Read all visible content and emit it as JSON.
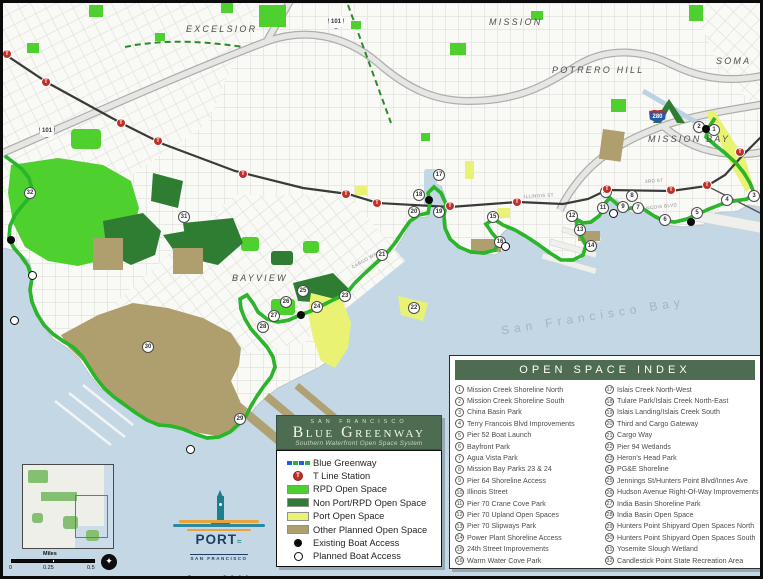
{
  "map": {
    "neighborhoods": [
      {
        "label": "EXCELSIOR",
        "x": 183,
        "y": 21
      },
      {
        "label": "MISSION",
        "x": 486,
        "y": 14
      },
      {
        "label": "POTRERO HILL",
        "x": 549,
        "y": 62
      },
      {
        "label": "SOMA",
        "x": 713,
        "y": 53
      },
      {
        "label": "MISSION BAY",
        "x": 645,
        "y": 131
      },
      {
        "label": "BAYVIEW",
        "x": 229,
        "y": 270
      }
    ],
    "bay_label": "San Francisco Bay",
    "street_labels": [
      {
        "label": "3RD ST",
        "x": 642,
        "y": 176,
        "rot": -4
      },
      {
        "label": "ILLINOIS ST",
        "x": 521,
        "y": 191,
        "rot": -3
      },
      {
        "label": "CARGO WAY",
        "x": 349,
        "y": 262,
        "rot": -30
      },
      {
        "label": "TERRY A FRANCOIS BLVD",
        "x": 610,
        "y": 206,
        "rot": -6
      }
    ],
    "shields": [
      {
        "system": "US",
        "label": "101"
      },
      {
        "system": "US",
        "label": "101"
      },
      {
        "system": "Interstate",
        "label": "280"
      }
    ],
    "markers": [
      {
        "n": 1,
        "x": 711,
        "y": 127
      },
      {
        "n": 2,
        "x": 696,
        "y": 124
      },
      {
        "n": 3,
        "x": 751,
        "y": 193
      },
      {
        "n": 4,
        "x": 724,
        "y": 197
      },
      {
        "n": 5,
        "x": 694,
        "y": 210
      },
      {
        "n": 6,
        "x": 662,
        "y": 217
      },
      {
        "n": 7,
        "x": 635,
        "y": 205
      },
      {
        "n": 8,
        "x": 629,
        "y": 193
      },
      {
        "n": 9,
        "x": 620,
        "y": 204
      },
      {
        "n": 10,
        "x": 603,
        "y": 189
      },
      {
        "n": 11,
        "x": 600,
        "y": 205
      },
      {
        "n": 12,
        "x": 569,
        "y": 213
      },
      {
        "n": 13,
        "x": 577,
        "y": 227
      },
      {
        "n": 14,
        "x": 588,
        "y": 243
      },
      {
        "n": 15,
        "x": 490,
        "y": 214
      },
      {
        "n": 16,
        "x": 497,
        "y": 239
      },
      {
        "n": 17,
        "x": 436,
        "y": 172
      },
      {
        "n": 18,
        "x": 416,
        "y": 192
      },
      {
        "n": 19,
        "x": 436,
        "y": 209
      },
      {
        "n": 20,
        "x": 411,
        "y": 209
      },
      {
        "n": 21,
        "x": 379,
        "y": 252
      },
      {
        "n": 22,
        "x": 411,
        "y": 305
      },
      {
        "n": 23,
        "x": 342,
        "y": 293
      },
      {
        "n": 24,
        "x": 314,
        "y": 304
      },
      {
        "n": 25,
        "x": 300,
        "y": 288
      },
      {
        "n": 26,
        "x": 283,
        "y": 299
      },
      {
        "n": 27,
        "x": 271,
        "y": 313
      },
      {
        "n": 28,
        "x": 260,
        "y": 324
      },
      {
        "n": 29,
        "x": 237,
        "y": 416
      },
      {
        "n": 30,
        "x": 145,
        "y": 344
      },
      {
        "n": 31,
        "x": 181,
        "y": 214
      },
      {
        "n": 32,
        "x": 27,
        "y": 190
      }
    ],
    "t_stations": [
      [
        4,
        51
      ],
      [
        43,
        79
      ],
      [
        118,
        120
      ],
      [
        155,
        138
      ],
      [
        240,
        171
      ],
      [
        343,
        191
      ],
      [
        374,
        200
      ],
      [
        447,
        203
      ],
      [
        514,
        199
      ],
      [
        604,
        186
      ],
      [
        668,
        187
      ],
      [
        704,
        182
      ],
      [
        737,
        149
      ]
    ],
    "existing_boat_access": [
      [
        703,
        126
      ],
      [
        688,
        219
      ],
      [
        426,
        197
      ],
      [
        298,
        312
      ],
      [
        8,
        237
      ]
    ],
    "planned_boat_access": [
      [
        610,
        210
      ],
      [
        502,
        243
      ],
      [
        29,
        272
      ],
      [
        11,
        317
      ],
      [
        187,
        446
      ]
    ]
  },
  "colors": {
    "water": "#c3d7e5",
    "land": "#f9f9f6",
    "greenway_blue": "#1e5fe0",
    "greenway_green": "#2bb52b",
    "rpd_green": "#4ed02f",
    "non_port_green": "#2e7d33",
    "port_yellow": "#e9f272",
    "planned_tan": "#b09f6e",
    "panel_green": "#4d6c51",
    "t_red": "#c03028"
  },
  "title_block": {
    "city": "SAN FRANCISCO",
    "title": "Blue Greenway",
    "subtitle": "Southern Waterfront Open Space System"
  },
  "legend": {
    "items": [
      {
        "symbol": "greenway",
        "icon": "blue-greenway-dash-icon",
        "label": "Blue Greenway"
      },
      {
        "symbol": "tdot",
        "icon": "t-line-station-icon",
        "label": "T Line Station"
      },
      {
        "symbol": "chip",
        "color": "#4ed02f",
        "icon": "rpd-open-space-swatch",
        "label": "RPD Open Space"
      },
      {
        "symbol": "chip",
        "color": "#2e7d33",
        "icon": "non-port-rpd-swatch",
        "label": "Non Port/RPD Open Space"
      },
      {
        "symbol": "chip",
        "color": "#e9f272",
        "icon": "port-open-space-swatch",
        "label": "Port Open Space"
      },
      {
        "symbol": "chip",
        "color": "#b09f6e",
        "icon": "other-planned-swatch",
        "label": "Other Planned Open Space"
      },
      {
        "symbol": "bdot",
        "icon": "existing-boat-access-icon",
        "label": "Existing Boat Access"
      },
      {
        "symbol": "pdot",
        "icon": "planned-boat-access-icon",
        "label": "Planned Boat Access"
      }
    ]
  },
  "index_panel": {
    "header": "OPEN SPACE INDEX",
    "left": [
      {
        "num": 1,
        "label": "Mission Creek Shoreline North"
      },
      {
        "num": 2,
        "label": "Mission Creek Shoreline South"
      },
      {
        "num": 3,
        "label": "China Basin Park"
      },
      {
        "num": 4,
        "label": "Terry Francois Blvd Improvements"
      },
      {
        "num": 5,
        "label": "Pier 52 Boat Launch"
      },
      {
        "num": 6,
        "label": "Bayfront Park"
      },
      {
        "num": 7,
        "label": "Agua Vista Park"
      },
      {
        "num": 8,
        "label": "Mission Bay Parks 23 & 24"
      },
      {
        "num": 9,
        "label": "Pier 64 Shoreline Access"
      },
      {
        "num": 10,
        "label": "Illinois Street"
      },
      {
        "num": 11,
        "label": "Pier 70 Crane Cove Park"
      },
      {
        "num": 12,
        "label": "Pier 70 Upland Open Spaces"
      },
      {
        "num": 13,
        "label": "Pier 70 Slipways Park"
      },
      {
        "num": 14,
        "label": "Power Plant Shoreline Access"
      },
      {
        "num": 15,
        "label": "24th Street Improvements"
      },
      {
        "num": 16,
        "label": "Warm Water Cove Park"
      }
    ],
    "right": [
      {
        "num": 17,
        "label": "Islais Creek North-West"
      },
      {
        "num": 18,
        "label": "Tulare Park/Islais Creek North-East"
      },
      {
        "num": 19,
        "label": "Islais Landing/Islais Creek South"
      },
      {
        "num": 20,
        "label": "Third and Cargo Gateway"
      },
      {
        "num": 21,
        "label": "Cargo Way"
      },
      {
        "num": 22,
        "label": "Pier 94 Wetlands"
      },
      {
        "num": 23,
        "label": "Heron's Head Park"
      },
      {
        "num": 24,
        "label": "PG&E Shoreline"
      },
      {
        "num": 25,
        "label": "Jennings St/Hunters Point Blvd/Innes Ave"
      },
      {
        "num": 26,
        "label": "Hudson Avenue Right-Of-Way Improvements"
      },
      {
        "num": 27,
        "label": "India Basin Shoreline Park"
      },
      {
        "num": 28,
        "label": "India Basin Open Space"
      },
      {
        "num": 29,
        "label": "Hunters Point Shipyard Open Spaces North"
      },
      {
        "num": 30,
        "label": "Hunters Point Shipyard Open Spaces South"
      },
      {
        "num": 31,
        "label": "Yosemite Slough Wetland"
      },
      {
        "num": 32,
        "label": "Candlestick Point State Recreation Area"
      }
    ]
  },
  "scale": {
    "label": "Miles",
    "ticks": [
      {
        "label": "0",
        "x": 0
      },
      {
        "label": "0.25",
        "x": 34
      },
      {
        "label": "0.5",
        "x": 78
      }
    ]
  },
  "logo": {
    "port": "PORT",
    "squiggle": "≈",
    "sub": "SAN FRANCISCO",
    "date": "June 2011"
  }
}
